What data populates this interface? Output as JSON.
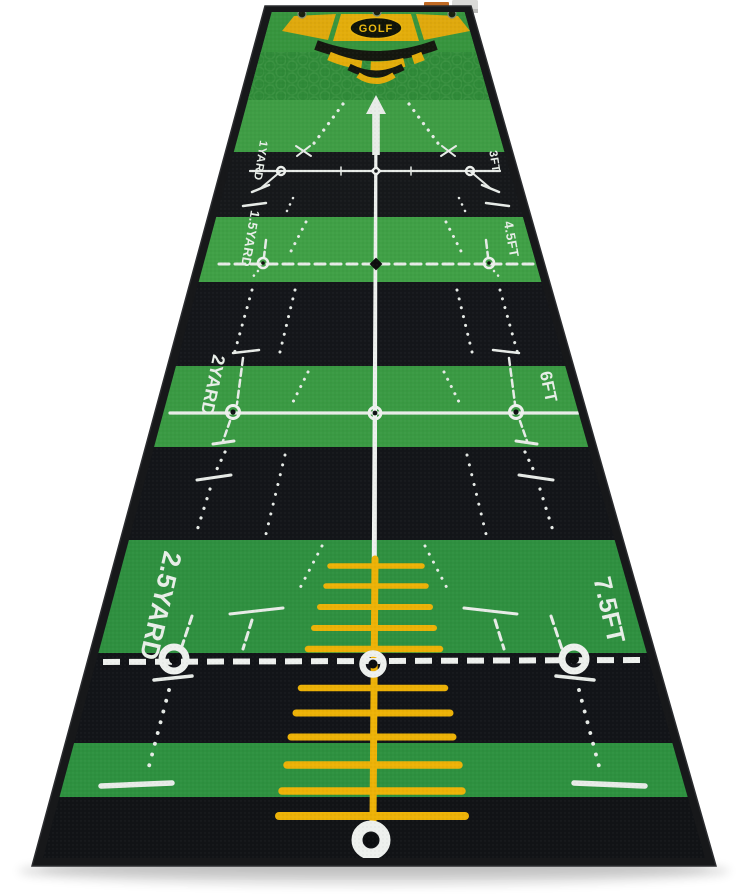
{
  "page": {
    "background": "#ffffff"
  },
  "mat": {
    "brand": "GOLF",
    "stations": [
      {
        "left": "1YARD",
        "right": "3FT"
      },
      {
        "left": "1.5YARD",
        "right": "4.5FT"
      },
      {
        "left": "2YARD",
        "right": "6FT"
      },
      {
        "left": "2.5YARD",
        "right": "7.5FT"
      }
    ],
    "colors": {
      "green_light": "#40a046",
      "green_mid": "#3a9a43",
      "green_deep": "#2f9040",
      "stripe_black": "#14161a",
      "border_black": "#17181a",
      "marking_white": "#e8ece8",
      "accent_yellow": "#e3ad0b",
      "ladder_yellow": "#edb207"
    }
  }
}
